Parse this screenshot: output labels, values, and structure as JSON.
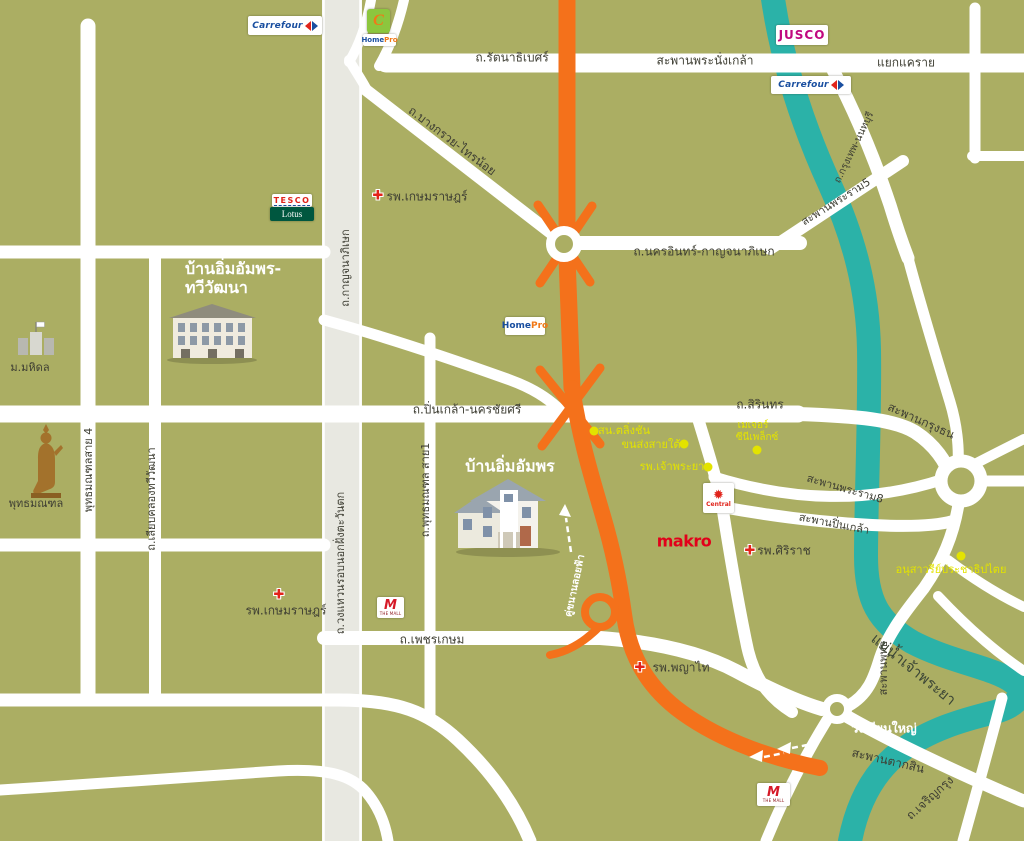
{
  "colors": {
    "land": "#ABAE63",
    "river": "#2BB2A8",
    "expressway_orange": "#F4711B",
    "road_white": "#FFFFFF",
    "ring_road_gray": "#E8E8E1",
    "label_dark": "#3E3E33",
    "poi_yellow": "#E3E300",
    "brand_red": "#E2231A"
  },
  "labels": {
    "rattanathibet": "ถ.รัตนาธิเบศร์",
    "phra_nangklao": "สะพานพระนั่งเกล้า",
    "yaek_khae_rai": "แยกแคราย",
    "bangkruai": "ถ.บางกรวย-ไทรน้อย",
    "krungthep_non": "ถ.กรุงเทพ-นนทบุรี",
    "nakhon_in": "ถ.นครอินทร์-กาญจนาภิเษก",
    "rama5": "สะพานพระราม5",
    "kanchanaphisek": "ถ.กาญจนาภิเษก",
    "pinklao_nakhonchaisi": "ถ.ปิ่นเกล้า-นครชัยศรี",
    "sirinthon": "ถ.สิรินทร",
    "krungthon": "สะพานกรุงธน",
    "rama8": "สะพานพระราม8",
    "pinklao_bridge": "สะพานปิ่นเกล้า",
    "saphan_phut": "สะพานพุทธ",
    "chaophraya_river": "แม่น้ำเจ้าพระยา",
    "wongwaen_west": "ถ.วงแหวนรอบนอกฝั่งตะวันตก",
    "sai1": "ถ.พุทธมณฑล สาย1",
    "sai4": "พุทธมณฑลสาย 4",
    "liap_khlong": "ถ.เลียบคลองทวีวัฒนา",
    "phetkasem": "ถ.เพชรเกษม",
    "khukhanan": "คู่ขนานลอยฟ้า",
    "wongwian_yai": "วงเวียนใหญ่",
    "taksin": "สะพานตากสิน",
    "charoen_krung": "ถ.เจริญกรุง",
    "mahidol": "ม.มหิดล",
    "phutthamonthon": "พุทธมณฑล"
  },
  "pois": {
    "taling_chan": "สน.ตลิ่งชัน",
    "southern_terminal": "ขนส่งสายใต้",
    "major_line1": "เมเจอร์",
    "major_line2": "ซีนีเพล็กซ์",
    "chaophraya_hospital": "รพ.เจ้าพระยา",
    "democracy": "อนุสาวรีย์ประชาธิปไตย"
  },
  "hospitals": {
    "kasem_rat": "รพ.เกษมราษฎร์",
    "siriraj": "รพ.ศิริราช",
    "phayathai": "รพ.พญาไท"
  },
  "houses": {
    "h1_line1": "บ้านอิ่มอัมพร-",
    "h1_line2": "ทวีวัฒนา",
    "h2": "บ้านอิ่มอัมพร"
  },
  "logos": {
    "carrefour": "Carrefour",
    "jusco": "JUSCO",
    "tesco": "TESCO",
    "lotus": "Lotus",
    "home": "Home",
    "pro": "Pro",
    "central": "Central",
    "makro": "makro",
    "the_mall": "THE MALL",
    "c_badge": "C"
  },
  "icons": {
    "hospital_cross": "✚",
    "central_star": "✹"
  }
}
